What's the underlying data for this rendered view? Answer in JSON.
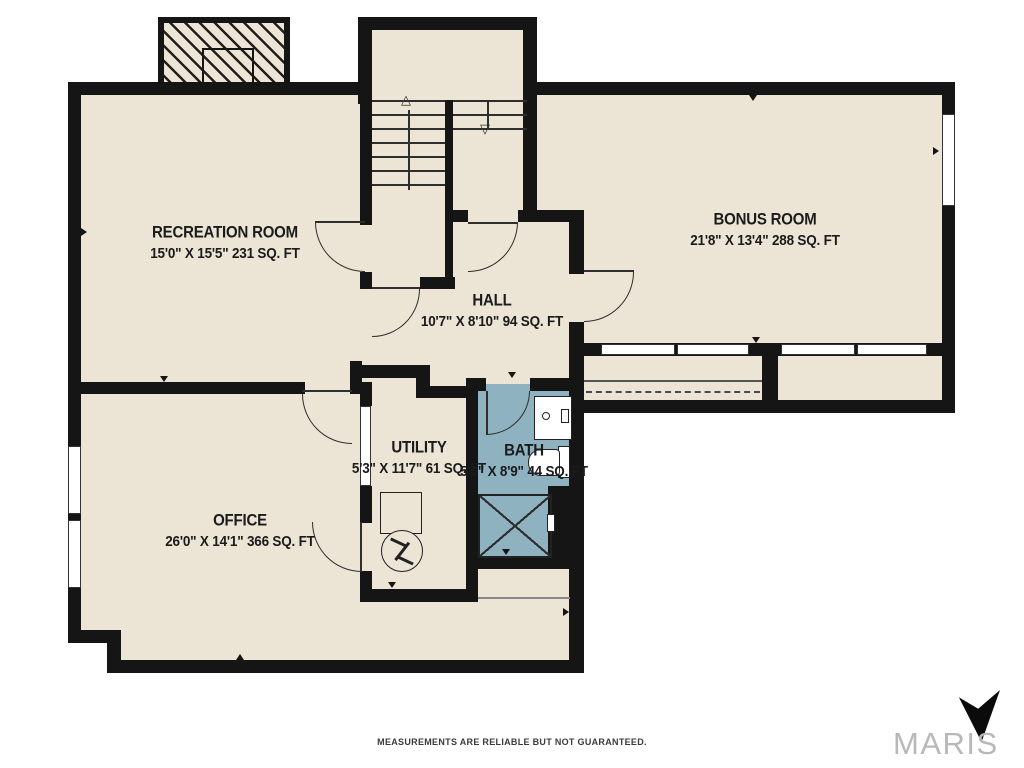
{
  "colors": {
    "floor": "#ece5d6",
    "bath_floor": "#8fb2c1",
    "wall": "#151515",
    "line": "#2e2e2e",
    "brand_gray": "#b8b8b8"
  },
  "rooms": [
    {
      "name": "RECREATION ROOM",
      "dims": "15'0\" X 15'5\" 231 SQ. FT"
    },
    {
      "name": "BONUS ROOM",
      "dims": "21'8\" X 13'4\" 288 SQ. FT"
    },
    {
      "name": "HALL",
      "dims": "10'7\" X 8'10\" 94 SQ. FT"
    },
    {
      "name": "UTILITY",
      "dims": "5'3\" X 11'7\" 61 SQ. FT"
    },
    {
      "name": "BATH",
      "dims": "5'0\" X 8'9\" 44 SQ. FT"
    },
    {
      "name": "OFFICE",
      "dims": "26'0\" X 14'1\" 366 SQ. FT"
    }
  ],
  "stairs": {
    "up_arrow": "△",
    "down_arrow": "▽"
  },
  "footer": {
    "disclaimer": "MEASUREMENTS ARE RELIABLE BUT NOT GUARANTEED.",
    "brand": "MARIS"
  }
}
